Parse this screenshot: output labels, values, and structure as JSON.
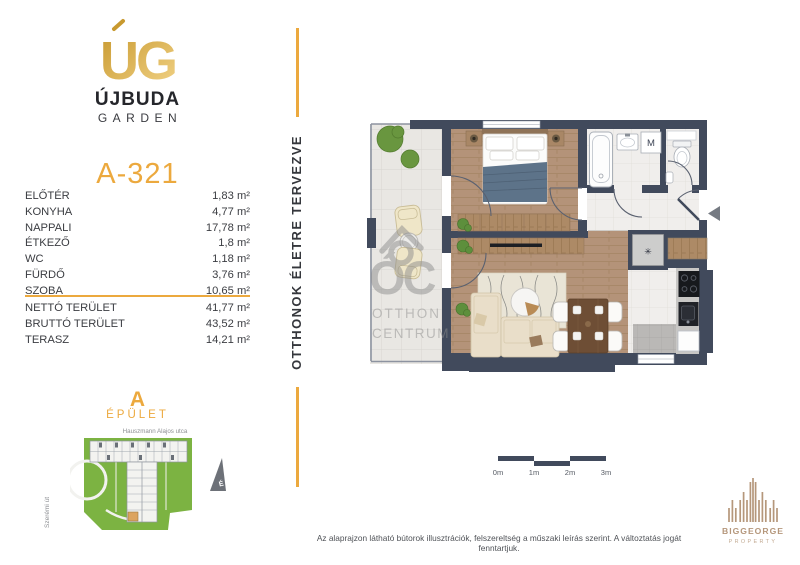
{
  "brand": {
    "monogram": "UG",
    "name": "ÚJBUDA",
    "sub": "GARDEN"
  },
  "unit": {
    "id": "A-321"
  },
  "area_unit": "m²",
  "rooms": [
    {
      "label": "ELŐTÉR",
      "area": "1,83"
    },
    {
      "label": "KONYHA",
      "area": "4,77"
    },
    {
      "label": "NAPPALI",
      "area": "17,78"
    },
    {
      "label": "ÉTKEZŐ",
      "area": "1,8"
    },
    {
      "label": "WC",
      "area": "1,18"
    },
    {
      "label": "FÜRDŐ",
      "area": "3,76"
    },
    {
      "label": "SZOBA",
      "area": "10,65"
    }
  ],
  "totals": [
    {
      "label": "NETTÓ TERÜLET",
      "area": "41,77"
    },
    {
      "label": "BRUTTÓ TERÜLET",
      "area": "43,52"
    },
    {
      "label": "TERASZ",
      "area": "14,21"
    }
  ],
  "building": {
    "letter": "A",
    "label": "ÉPÜLET"
  },
  "map": {
    "street_top": "Hauszmann Alajos utca",
    "street_left": "Szerémi út",
    "north": "É"
  },
  "tagline": "OTTHONOK ÉLETRE TERVEZVE",
  "floorplan": {
    "washing_machine": "M",
    "shaft_symbol": "✳",
    "watermark": {
      "big": "ÓC",
      "line1": "OTTHON",
      "line2": "CENTRUM"
    }
  },
  "scalebar": {
    "labels": [
      "0m",
      "1m",
      "2m",
      "3m"
    ]
  },
  "disclaimer": "Az alaprajzon látható bútorok illusztrációk, felszereltség a műszaki leírás szerint. A változtatás jogát fenntartjuk.",
  "footer_brand": {
    "name": "BIGGEORGE",
    "sub": "PROPERTY"
  },
  "colors": {
    "gold": "#ECA93E",
    "wall": "#414A5C",
    "green": "#7CB342",
    "tan": "#B5977B"
  }
}
